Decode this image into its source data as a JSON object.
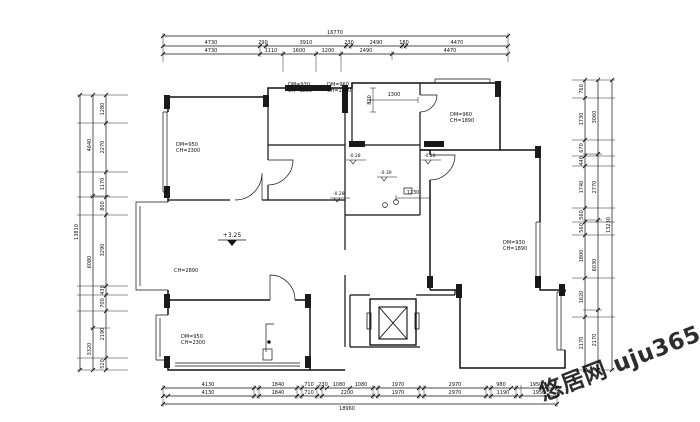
{
  "dims": {
    "top": {
      "total": "16770",
      "row1": [
        "4730",
        "290",
        "3910",
        "230",
        "2490",
        "180",
        "4470"
      ],
      "row2": [
        "4730",
        "1110",
        "1600",
        "1200",
        "2490",
        "4470"
      ]
    },
    "bottom": {
      "total": "18960",
      "row1": [
        "4130",
        "1840",
        "710",
        "230",
        "1080",
        "1080",
        "1970",
        "2970",
        "980",
        "1950"
      ],
      "row2": [
        "4130",
        "1840",
        "710",
        "2200",
        "1970",
        "2970",
        "1190",
        "1950"
      ]
    },
    "left": {
      "total": "13810",
      "outer": [
        "4640",
        "6080",
        "3320"
      ],
      "inner": [
        "1280",
        "2270",
        "1170",
        "800",
        "3290",
        "430",
        "700",
        "2190",
        "520"
      ]
    },
    "right": {
      "total": "13230",
      "outer": [
        "3060",
        "2770",
        "6030",
        "2170"
      ],
      "inner": [
        "760",
        "1730",
        "670",
        "440",
        "1740",
        "560",
        "560",
        "1800",
        "1620",
        "2170"
      ]
    }
  },
  "inner_dims": {
    "d1300": "1300",
    "d1230": "1230",
    "d820": "820"
  },
  "levels": {
    "main": "+3.25",
    "m1": "-0.28",
    "m2": "-0.28",
    "m3": "-0.28",
    "m4": "-0.39"
  },
  "labels": {
    "nw1": "DM=950",
    "nw2": "CH=2300",
    "n1a": "DM=930",
    "n1b": "CH=1890",
    "n2a": "DM=960",
    "n2b": "CH=1900",
    "nea": "DM=960",
    "neb": "CH=1890",
    "ea": "DM=930",
    "eb": "CH=1890",
    "swa": "DM=950",
    "swb": "CH=2300",
    "living_ch": "CH=2890"
  },
  "watermark": {
    "text": "悠居网 uju365.com",
    "color": "#29c5e6"
  }
}
